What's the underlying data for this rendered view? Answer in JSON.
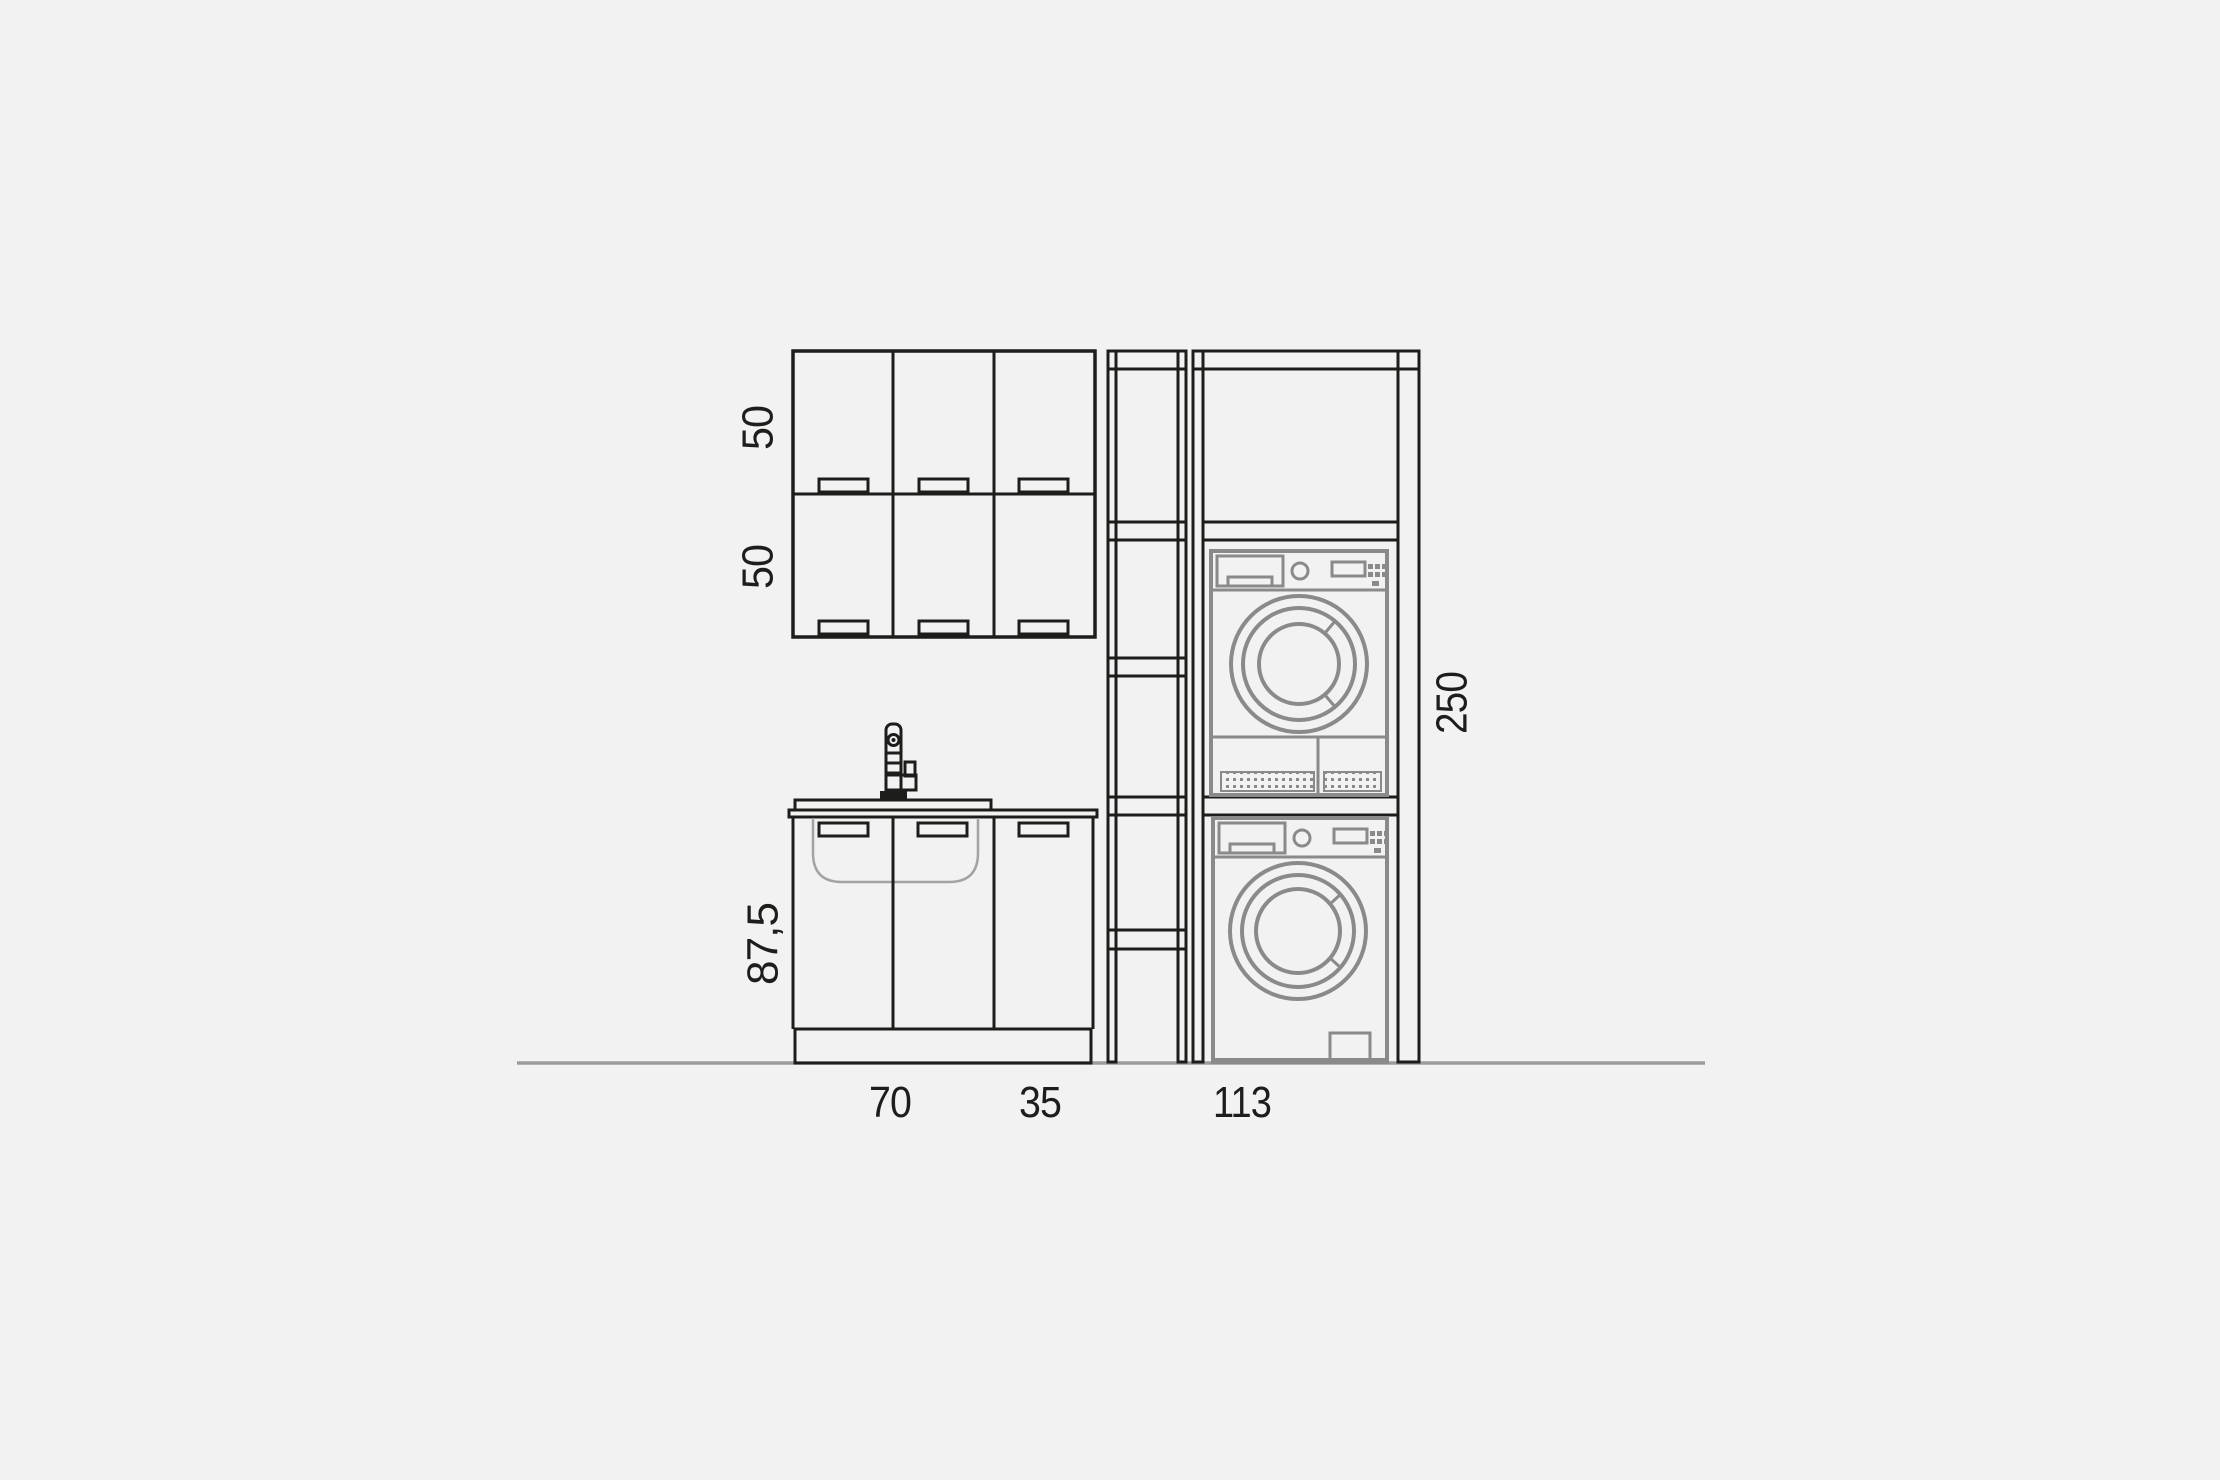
{
  "page": {
    "background_color": "#f2f2f2",
    "title": "laundry-cabinet-elevation-drawing"
  },
  "drawing": {
    "type": "technical-elevation",
    "colors": {
      "cabinet_line": "#1d1d1b",
      "appliance_line": "#8a8a8a",
      "sink_outline": "#a3a3a3",
      "ground_line": "#9c9c9c",
      "text": "#1d1d1b"
    },
    "dimensions": {
      "wall_units_row1_height": "50",
      "wall_units_row2_height": "50",
      "base_units_height": "87,5",
      "column_height": "250",
      "sink_unit_width": "70",
      "base_unit_width": "35",
      "appliance_column_width": "113"
    }
  }
}
